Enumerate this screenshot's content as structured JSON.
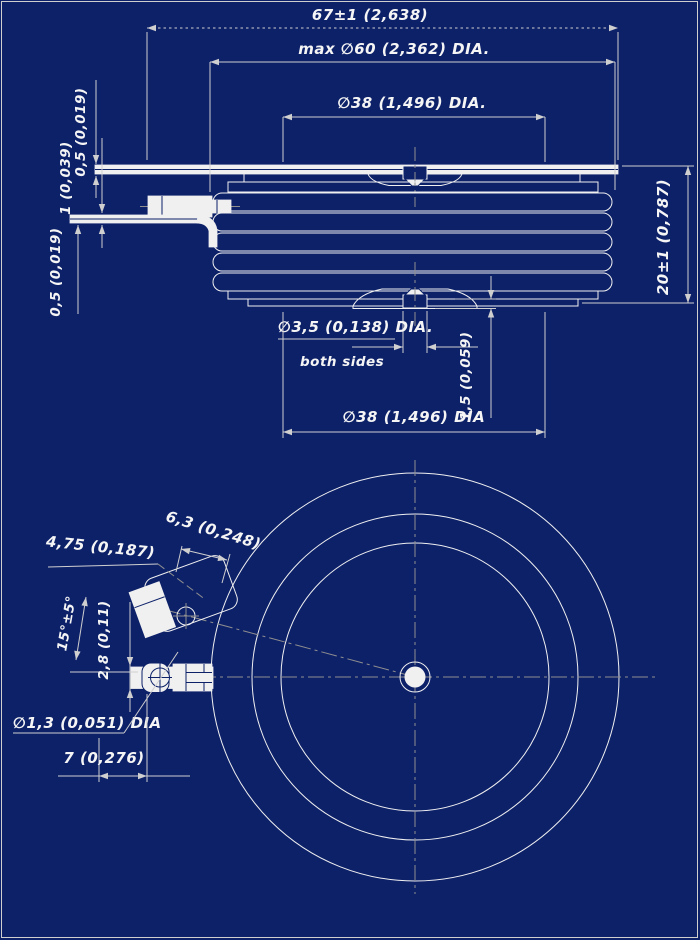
{
  "colors": {
    "background": "#0d2169",
    "line": "#f0f0f0",
    "dim_line": "#cfcfcf",
    "centerline": "#8f8f8f",
    "text": "#f5f5f5"
  },
  "side_view": {
    "overall_length": "67±1 (2,638)",
    "max_body_dia": "max ∅60 (2,362) DIA.",
    "pole_face_dia_top": "∅38 (1,496) DIA.",
    "top_lead_thickness": "0,5 (0,019)",
    "mid_lead_thickness": "1 (0,039)",
    "bottom_lead_thickness": "0,5 (0,019)",
    "body_height": "20±1 (0,787)",
    "gate_hole_dia": "∅3,5 (0,138) DIA.",
    "gate_hole_note": "both sides",
    "recess_depth": "1,5 (0,059)",
    "pole_face_dia_bottom": "∅38 (1,496) DIA"
  },
  "bottom_view": {
    "terminal_width": "4,75 (0,187)",
    "terminal_length": "6,3 (0,248)",
    "lead_angle": "15°±5°",
    "terminal_offset": "2,8 (0,11)",
    "pin_hole_dia": "∅1,3 (0,051) DIA",
    "pin_distance": "7 (0,276)"
  }
}
